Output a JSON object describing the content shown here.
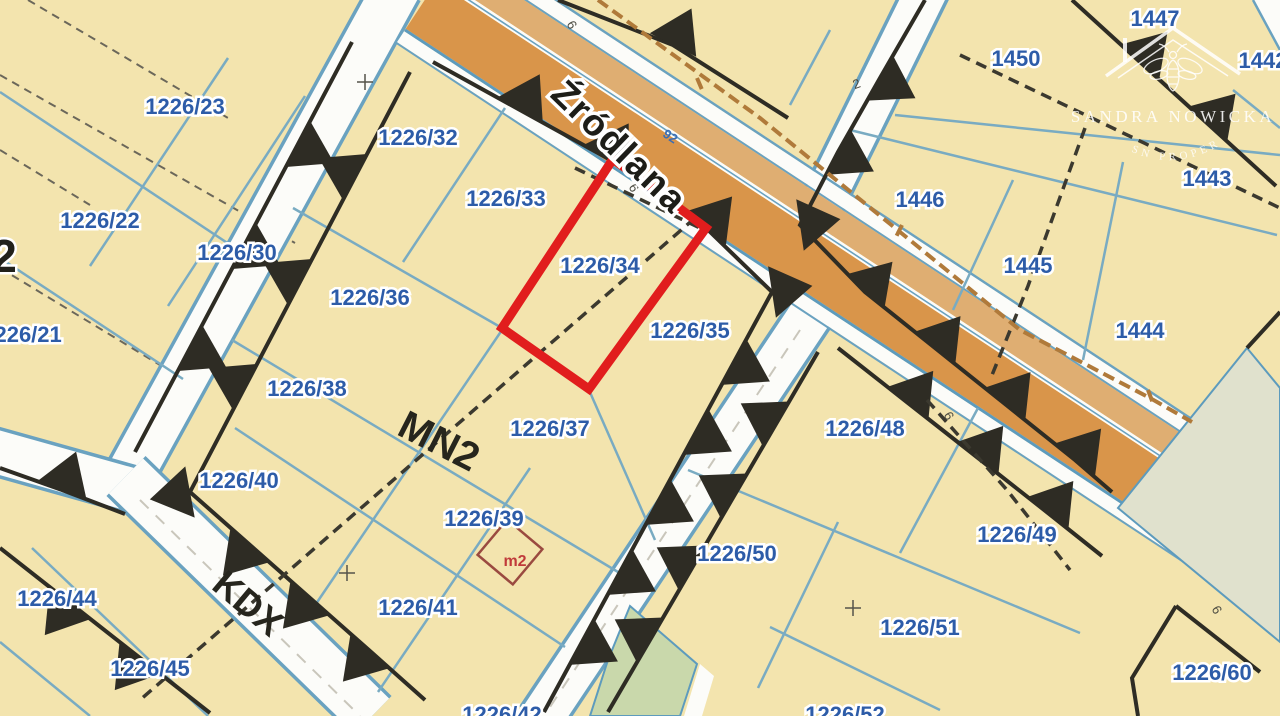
{
  "map": {
    "street": {
      "name": "Źródlana"
    },
    "zones": [
      {
        "label": "MN2"
      },
      {
        "label": "KDX"
      }
    ],
    "parcels": [
      {
        "t": "1226/23"
      },
      {
        "t": "1226/22"
      },
      {
        "t": "1226/21"
      },
      {
        "t": "1226/30"
      },
      {
        "t": "1226/32"
      },
      {
        "t": "1226/33"
      },
      {
        "t": "1226/36"
      },
      {
        "t": "1226/34"
      },
      {
        "t": "1226/35"
      },
      {
        "t": "1226/38"
      },
      {
        "t": "1226/37"
      },
      {
        "t": "1226/40"
      },
      {
        "t": "1226/39"
      },
      {
        "t": "1226/41"
      },
      {
        "t": "1226/42"
      },
      {
        "t": "1226/44"
      },
      {
        "t": "1226/45"
      },
      {
        "t": "1226/48"
      },
      {
        "t": "1226/49"
      },
      {
        "t": "1226/50"
      },
      {
        "t": "1226/51"
      },
      {
        "t": "1226/52"
      },
      {
        "t": "1226/60"
      },
      {
        "t": "1447"
      },
      {
        "t": "1450"
      },
      {
        "t": "1442"
      },
      {
        "t": "1443"
      },
      {
        "t": "1446"
      },
      {
        "t": "1445"
      },
      {
        "t": "1444"
      }
    ],
    "block_number": "2",
    "marker_m2": "m2",
    "small_labels": [
      {
        "t": "6"
      },
      {
        "t": "6"
      },
      {
        "t": "6"
      },
      {
        "t": "6"
      },
      {
        "t": "92"
      },
      {
        "t": "2"
      }
    ],
    "highlight": {
      "parcel": "1226/34",
      "color": "#e11d1d"
    },
    "colors": {
      "parcel_fill": "#f3e4ae",
      "road_orange": "#d9954a",
      "road_tan": "#dfae72",
      "road_white": "#fcfcf9",
      "boundary_teal": "#79abc2",
      "boundary_black": "#2e2c24",
      "label_blue": "#2d5ca8",
      "green_area": "#c9d8ab",
      "green_gray_area": "#e0e1cd",
      "marker_red": "#c03a3a"
    }
  },
  "watermark": {
    "brand": "SANDRA NOWICKA",
    "tagline": "SN PROPERTY"
  }
}
